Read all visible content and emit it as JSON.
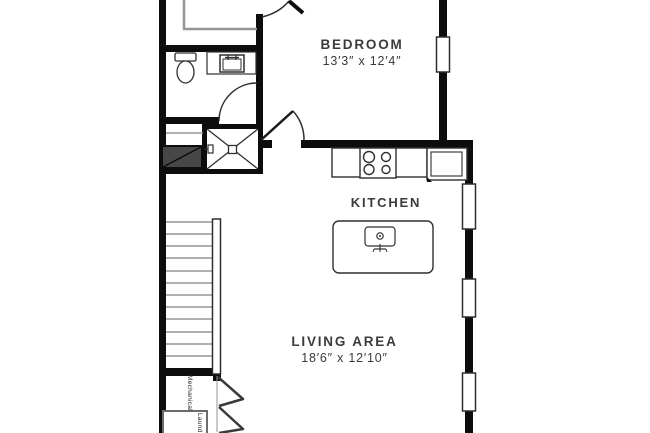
{
  "title": "Floor plan",
  "rooms": {
    "bedroom": {
      "label": "BEDROOM",
      "dims": "13′3″ x 12′4″"
    },
    "kitchen": {
      "label": "KITCHEN"
    },
    "living_area": {
      "label": "LIVING AREA",
      "dims": "18′6″ x 12′10″"
    },
    "mechanical": {
      "label": "Mechanical"
    },
    "laundry": {
      "label": "Laundry"
    }
  },
  "fixtures": [
    "toilet-icon",
    "vanity-sink-icon",
    "shower-icon",
    "stove-icon",
    "fridge-icon",
    "kitchen-island",
    "island-sink-icon",
    "stairs",
    "handrail",
    "windows",
    "door-swing-icons",
    "bifold-door-icons"
  ],
  "colors": {
    "wall": "#0d0d0d",
    "line": "#2f2f2f",
    "muted": "#969696",
    "text": "#3b3b3b",
    "bg": "#ffffff",
    "darkfill": "#474747"
  }
}
